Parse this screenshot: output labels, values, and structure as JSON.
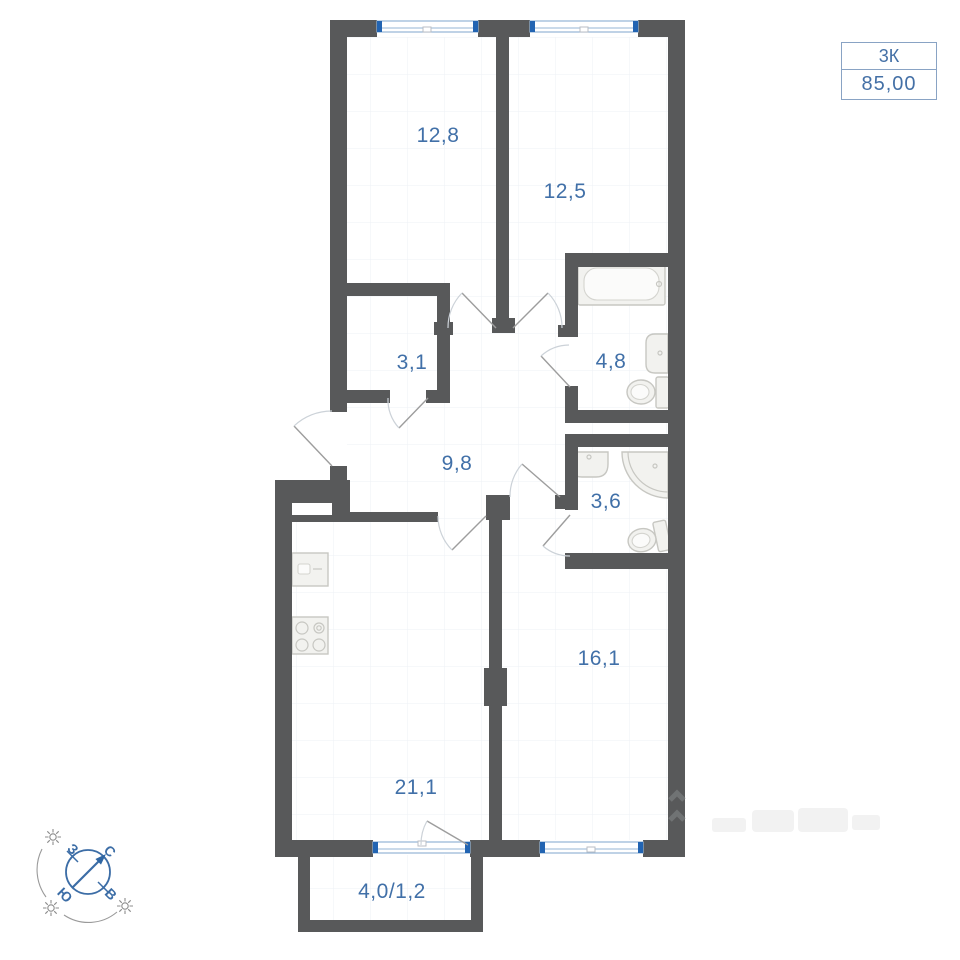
{
  "title_box": {
    "flat_type": "3К",
    "total_area": "85,00"
  },
  "plan": {
    "rooms": [
      {
        "name": "bedroom-1",
        "area": "12,8"
      },
      {
        "name": "bedroom-2",
        "area": "12,5"
      },
      {
        "name": "closet",
        "area": "3,1"
      },
      {
        "name": "bathroom",
        "area": "4,8"
      },
      {
        "name": "hallway",
        "area": "9,8"
      },
      {
        "name": "shower-room",
        "area": "3,6"
      },
      {
        "name": "living-room",
        "area": "16,1"
      },
      {
        "name": "kitchen-living-room",
        "area": "21,1"
      },
      {
        "name": "balcony",
        "area": "4,0/1,2"
      }
    ]
  },
  "compass": {
    "north": "С",
    "east": "В",
    "south": "Ю",
    "west": "З"
  },
  "colors": {
    "wall": "#58595a",
    "room_label": "#4170a8",
    "window_accent": "#2264b2",
    "window_frame": "#94b4d6",
    "compass_accent": "#3c6da6",
    "title_border": "#89a3c4",
    "title_text": "#4470a6",
    "fixture_fill": "#f2f2ef",
    "fixture_stroke": "#c7c7c2"
  }
}
